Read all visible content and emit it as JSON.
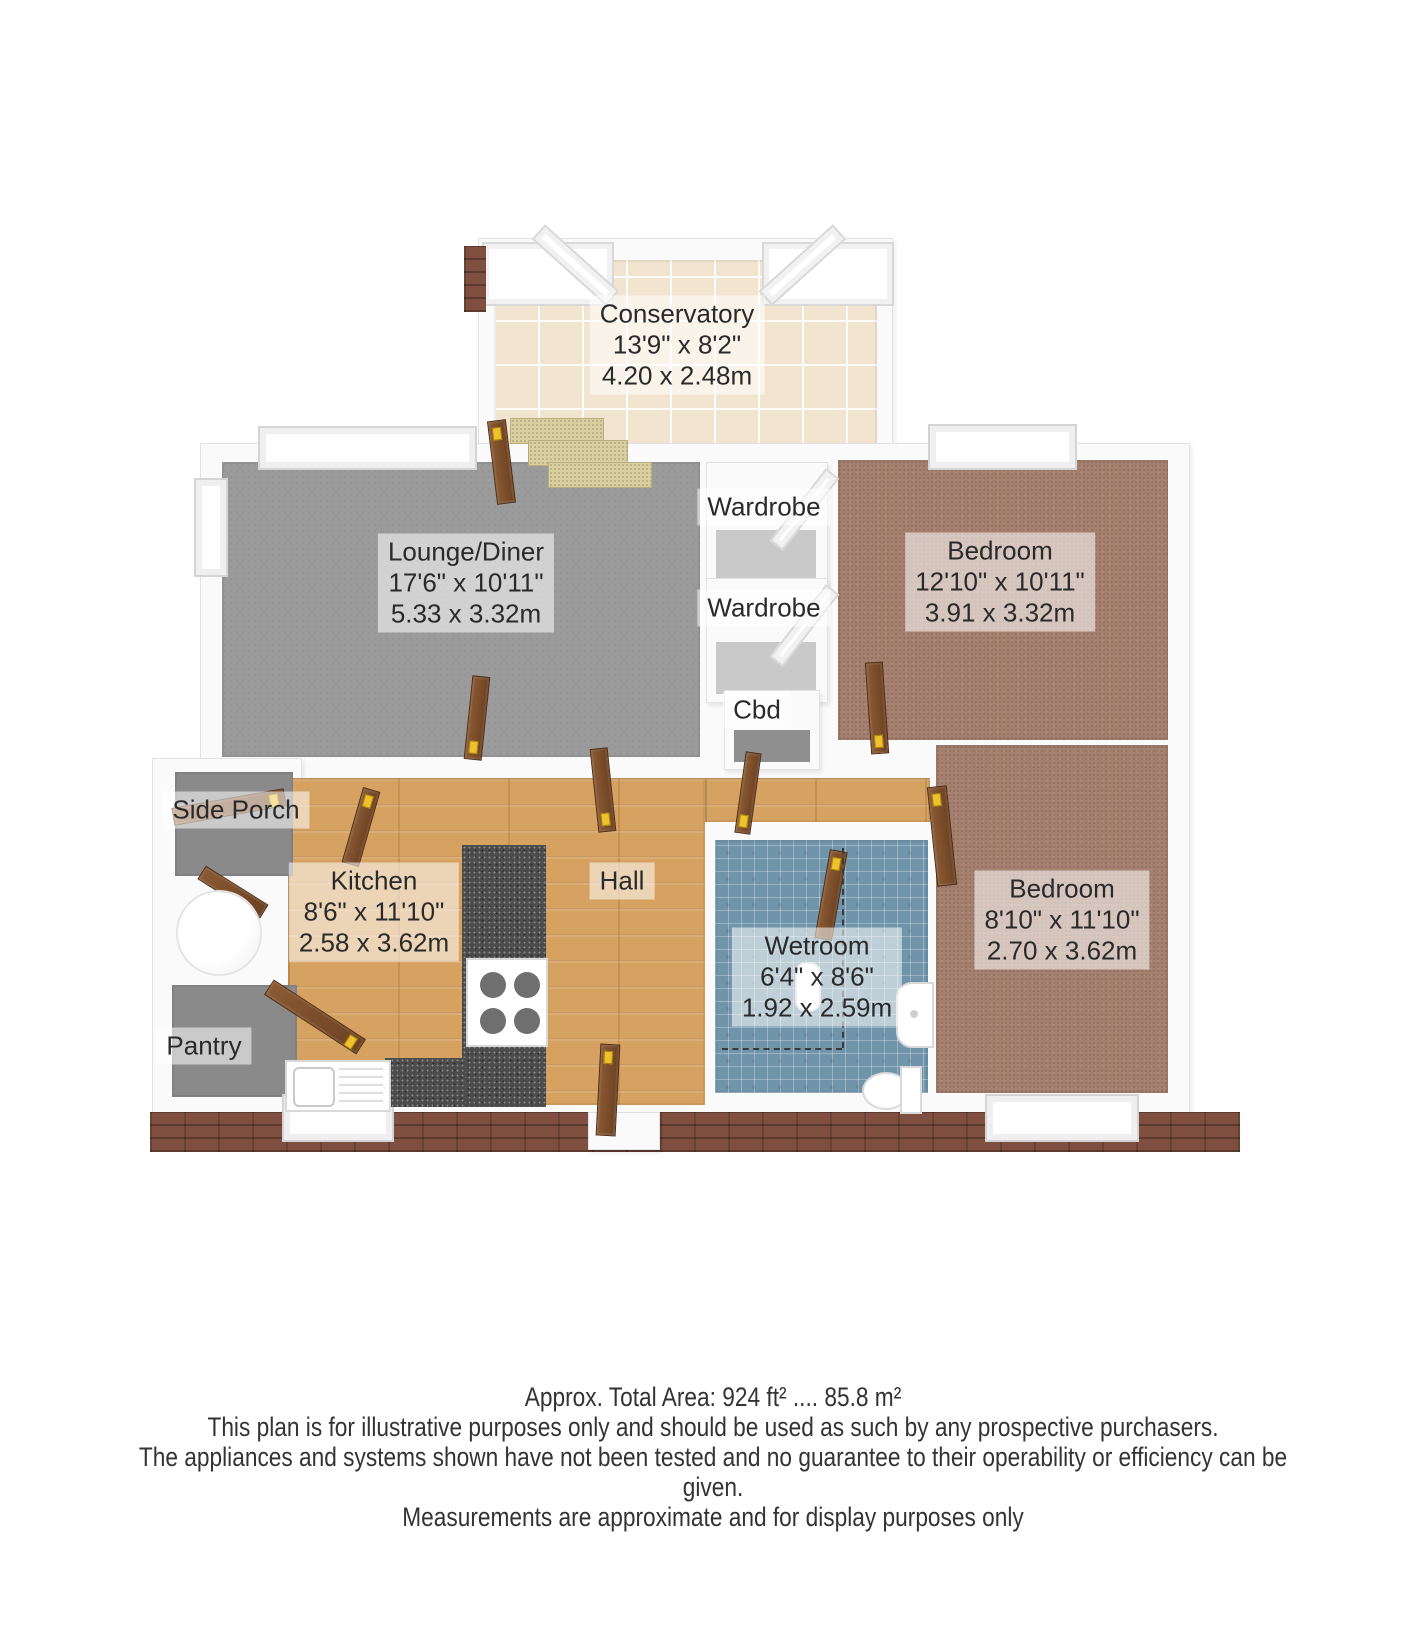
{
  "rooms": {
    "conservatory": {
      "name": "Conservatory",
      "imperial": "13'9\" x 8'2\"",
      "metric": "4.20 x 2.48m"
    },
    "lounge": {
      "name": "Lounge/Diner",
      "imperial": "17'6\" x 10'11\"",
      "metric": "5.33 x 3.32m"
    },
    "bedroom1": {
      "name": "Bedroom",
      "imperial": "12'10\" x 10'11\"",
      "metric": "3.91 x 3.32m"
    },
    "bedroom2": {
      "name": "Bedroom",
      "imperial": "8'10\" x 11'10\"",
      "metric": "2.70 x 3.62m"
    },
    "kitchen": {
      "name": "Kitchen",
      "imperial": "8'6\" x 11'10\"",
      "metric": "2.58 x 3.62m"
    },
    "wetroom": {
      "name": "Wetroom",
      "imperial": "6'4\" x 8'6\"",
      "metric": "1.92 x 2.59m"
    },
    "hall": {
      "name": "Hall"
    },
    "side_porch": {
      "name": "Side Porch"
    },
    "pantry": {
      "name": "Pantry"
    },
    "wardrobe1": {
      "name": "Wardrobe"
    },
    "wardrobe2": {
      "name": "Wardrobe"
    },
    "cbd": {
      "name": "Cbd"
    }
  },
  "footer": {
    "area_line": "Approx. Total Area: 924 ft² .... 85.8 m²",
    "disclaimer1": "This plan is for illustrative purposes only and should be used as such by any prospective purchasers.",
    "disclaimer2": "The appliances and systems shown have not been tested and no guarantee to their operability or efficiency can be given.",
    "disclaimer3": "Measurements are approximate and for display purposes only"
  },
  "colors": {
    "wood_floor": "#d6a261",
    "gray_carpet": "#9b9b9b",
    "bedroom_carpet": "#a5806f",
    "cream_tile": "#f1e5d0",
    "blue_tile": "#7094a9",
    "granite_worktop": "#4c4c4c",
    "brick": "#7f5040",
    "door_wood": "#7b4b2a",
    "door_handle": "#eec22c",
    "wall": "#fafafa"
  }
}
